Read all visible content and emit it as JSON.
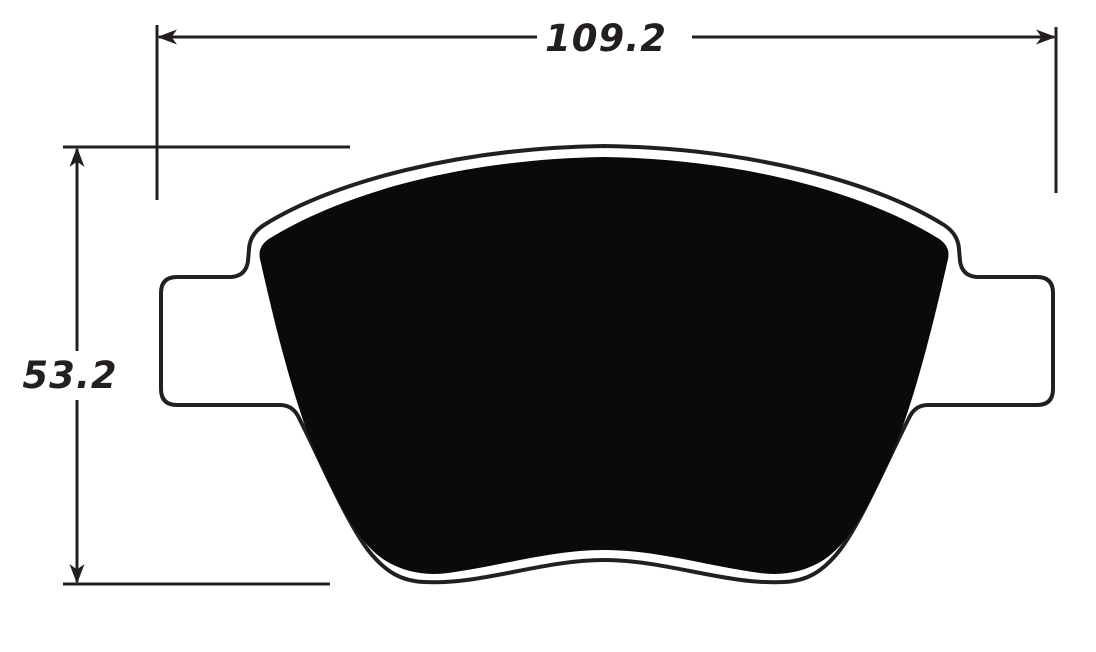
{
  "drawing": {
    "subject": "brake pad profile with dimensions",
    "background_color": "#ffffff",
    "line_color": "#231f20",
    "pad_color": "#0b0a0a",
    "plate_fill": "#ffffff",
    "width_dimension": {
      "value": "109.2"
    },
    "height_dimension": {
      "value": "53.2"
    }
  }
}
